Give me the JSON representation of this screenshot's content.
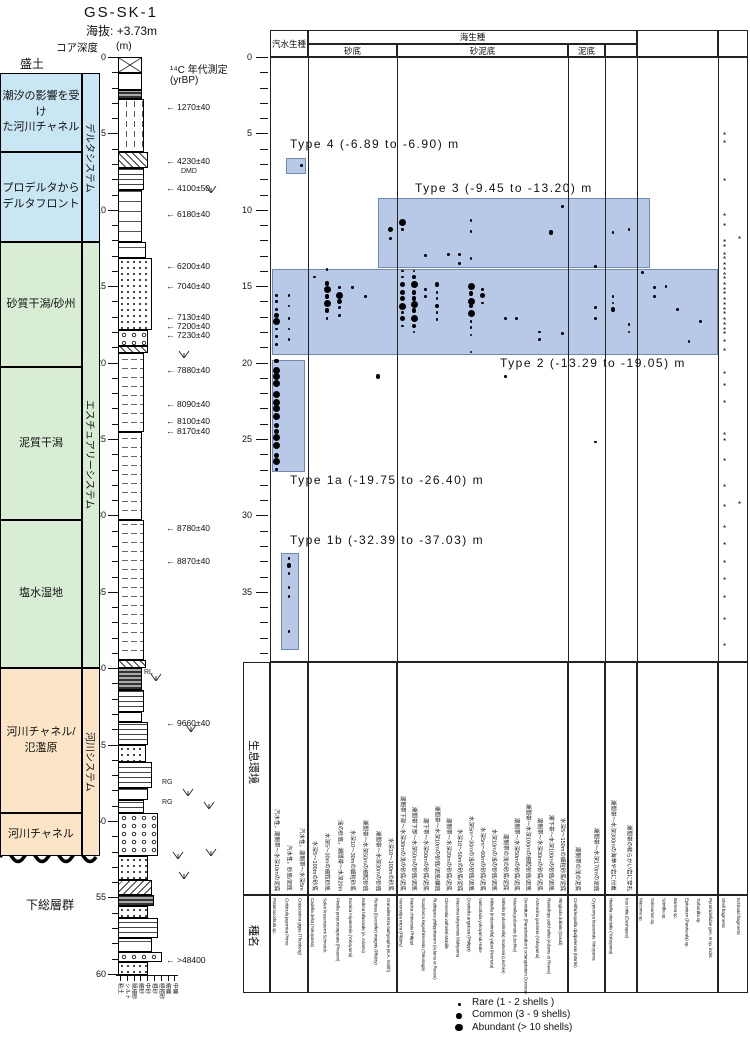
{
  "header": {
    "core_id": "GS-SK-1",
    "elevation_label": "海抜:",
    "elevation_value": "+3.73m",
    "core_depth_label": "コア深度",
    "depth_unit": "(m)",
    "c14_heading": "¹⁴C 年代測定",
    "c14_unit": "(yrBP)"
  },
  "left_panel": {
    "surface_label": "盛土",
    "basement_label": "下総層群",
    "environments": [
      {
        "label": "潮汐の影響を受け\nた河川チャネル",
        "color": "blue",
        "top_m": 1.05,
        "bottom_m": 6.22
      },
      {
        "label": "プロデルタから\nデルタフロント",
        "color": "blue",
        "top_m": 6.22,
        "bottom_m": 12.11
      },
      {
        "label": "砂質干潟/砂州",
        "color": "green",
        "top_m": 12.11,
        "bottom_m": 20.3
      },
      {
        "label": "泥質干潟",
        "color": "green",
        "top_m": 20.3,
        "bottom_m": 30.3
      },
      {
        "label": "塩水湿地",
        "color": "green",
        "top_m": 30.3,
        "bottom_m": 40.0
      },
      {
        "label": "河川チャネル/\n氾濫原",
        "color": "orange",
        "top_m": 40.0,
        "bottom_m": 49.5
      },
      {
        "label": "河川チャネル",
        "color": "orange",
        "top_m": 49.5,
        "bottom_m": 52.3
      }
    ],
    "systems": [
      {
        "label": "デルタシステム",
        "color": "blue",
        "top_m": 1.05,
        "bottom_m": 12.11
      },
      {
        "label": "エスチュアリーシステム",
        "color": "green",
        "top_m": 12.11,
        "bottom_m": 40.0
      },
      {
        "label": "河川システム",
        "color": "orange",
        "top_m": 40.0,
        "bottom_m": 52.3
      }
    ],
    "c14_dates": [
      {
        "label": "1270±40",
        "depth_m": 3.3
      },
      {
        "label": "4230±40",
        "depth_m": 6.8
      },
      {
        "label": "4100±50",
        "depth_m": 8.6
      },
      {
        "label": "6180±40",
        "depth_m": 10.3
      },
      {
        "label": "6200±40",
        "depth_m": 13.7
      },
      {
        "label": "7040±40",
        "depth_m": 15.0
      },
      {
        "label": "7130±40",
        "depth_m": 17.0
      },
      {
        "label": "7200±40",
        "depth_m": 17.6
      },
      {
        "label": "7230±40",
        "depth_m": 18.2
      },
      {
        "label": "7880±40",
        "depth_m": 20.5
      },
      {
        "label": "8090±40",
        "depth_m": 22.7
      },
      {
        "label": "8100±40",
        "depth_m": 23.8
      },
      {
        "label": "8170±40",
        "depth_m": 24.5
      },
      {
        "label": "8780±40",
        "depth_m": 30.8
      },
      {
        "label": "8870±40",
        "depth_m": 33.0
      },
      {
        "label": "9660±40",
        "depth_m": 43.6
      },
      {
        "label": ">48400",
        "depth_m": 59.1
      }
    ],
    "sed_marks": [
      {
        "label": "DMD",
        "depth_m": 7.5,
        "x": 181
      },
      {
        "label": "RL",
        "depth_m": 40.3,
        "x": 144
      },
      {
        "label": "RG",
        "depth_m": 47.5,
        "x": 162
      },
      {
        "label": "RG",
        "depth_m": 48.8,
        "x": 162
      }
    ],
    "grain_sizes": [
      "粘土",
      "シルト",
      "極細砂",
      "細砂",
      "中砂",
      "粗砂",
      "極粗砂",
      "細礫",
      "中礫"
    ]
  },
  "chart_data": {
    "type": "occurrence-matrix",
    "depth_axis": {
      "min": 0,
      "max": 39,
      "tick_step": 1,
      "label_step": 5,
      "unit": "m"
    },
    "marine_header": "海生種",
    "row_labels": {
      "habitat": "生息環境",
      "species": "種名"
    },
    "column_groups": [
      {
        "header": "汽水生種",
        "species": [
          {
            "name": "Potamocorbula sp.",
            "habitat": "汽水性，潮間帯～水深10mの泥底"
          },
          {
            "name": "Corbicula japonica Prime",
            "habitat": "汽水性，砂底/泥底"
          },
          {
            "name": "Crassostrea gigas (Thunberg)",
            "habitat": "汽水性，潮間帯～水深5m"
          }
        ]
      },
      {
        "header": "砂底",
        "species": [
          {
            "name": "Cadella delta (Yokoyama)",
            "habitat": "水深5～100mの砂底"
          },
          {
            "name": "Solen krusensterni Schrenck",
            "habitat": "水深5～30mの細粒砂底"
          },
          {
            "name": "Finella purpureoapicata (Preston)",
            "habitat": "浅の砂底，潮間帯～水深20m"
          },
          {
            "name": "Exotica miyatensis (Yokoyama)",
            "habitat": "水深10～30mの細粒砂底"
          },
          {
            "name": "Eulima bifascialis (A. Adams)",
            "habitat": "潮間帯～水深50mの細粒砂底"
          },
          {
            "name": "Retusa (Decorifer) insignis (Pilsbry)",
            "habitat": "潮間帯～水深30mの砂底"
          },
          {
            "name": "Granuliterebra bathyraphe (E.A. Smith)",
            "habitat": "水深10～100mの砂底"
          }
        ]
      },
      {
        "header": "砂泥底",
        "species": [
          {
            "name": "Veremolpa micra (Pilsbry)",
            "habitat": "潮間帯下部～水深30mの浅の砂底/泥底"
          },
          {
            "name": "Mactra chinensis Philippi",
            "habitat": "潮間帯下部～水深50mの砂底/泥底"
          },
          {
            "name": "Scapharca kagoshimensis (Tokunaga)",
            "habitat": "潮下帯～水深50mの砂底/泥底"
          },
          {
            "name": "Ruditapes philippinarum (Adams et Reeve)",
            "habitat": "潮間帯～水深10mの砂底/泥底/礫底"
          },
          {
            "name": "Clementia vatheleti Mabille",
            "habitat": "潮間帯～水深20mの砂底/泥底"
          },
          {
            "name": "Macoma tokyoensis Makiyama",
            "habitat": "水深10～50mの砂底/泥底"
          },
          {
            "name": "Dosinella angulosa (Philippi)",
            "habitat": "水深5m～30mの浅の砂底/泥底"
          },
          {
            "name": "Varicorbula yokoyamai Habe",
            "habitat": "水深5m～60mの砂底/泥底"
          },
          {
            "name": "Mitrella (Indomitrella) yabei (Nomura)",
            "habitat": "水深10mの浅の砂底/泥底"
          },
          {
            "name": "Mitrella (Indomitrella) martensi (Lischke)",
            "habitat": "潮間帯の浅の砂底/泥底"
          },
          {
            "name": "Moerella jedoensis (Lischke)",
            "habitat": "潮間帯～水深50mの砂底/泥底"
          },
          {
            "name": "Dentalium (Paradentalium) octangulatum Donovan",
            "habitat": "潮間帯～水深100mの細粒砂底/泥底"
          },
          {
            "name": "Acteocina gordonis (Yokoyama)",
            "habitat": "潮間帯～水深30mの砂底/泥底"
          },
          {
            "name": "Raetellops pulchellus (Adams et Reeve)",
            "habitat": "潮下帯～水深100mの砂底/泥底"
          },
          {
            "name": "Ringicula doliaris (Gould)",
            "habitat": "水深5～150mの細粒砂底/泥底"
          }
        ]
      },
      {
        "header": "泥底",
        "species": [
          {
            "name": "Cerithideopsilla djadjariensis (Martin)",
            "habitat": "潮間帯の浅の泥底"
          },
          {
            "name": "Cryptomya busoensis Yokoyama",
            "habitat": "潮間帯～水深170mの泥底"
          }
        ]
      },
      {
        "header": "",
        "species": [
          {
            "name": "Hiatella orientalis (Yokoyama)",
            "habitat": "潮間帯～水深300mの海草や岩に付着"
          },
          {
            "name": "Irus mitis (Deshayes)",
            "habitat": "潮間帯の軟らかい岩に穿孔"
          }
        ]
      },
      {
        "header": "",
        "species": [
          {
            "name": "Macoma sp.",
            "habitat": ""
          },
          {
            "name": "Solecurtus sp.",
            "habitat": ""
          },
          {
            "name": "Scintilla sp.",
            "habitat": ""
          },
          {
            "name": "Barnea sp.",
            "habitat": ""
          },
          {
            "name": "Epitonium (Parviscala) sp.",
            "habitat": ""
          },
          {
            "name": "Turbonilla sp.",
            "habitat": ""
          },
          {
            "name": "Pyramidellidae gen. et sp. indet.",
            "habitat": ""
          }
        ]
      },
      {
        "header": "",
        "species": [
          {
            "name": "Shell fragments",
            "habitat": ""
          },
          {
            "name": "Echinoid fragments",
            "habitat": ""
          }
        ]
      }
    ],
    "shell_types": [
      {
        "label": "Type 4 (-6.89 to -6.90) m"
      },
      {
        "label": "Type 3 (-9.45 to -13.20) m"
      },
      {
        "label": "Type 2 (-13.29 to -19.05) m"
      },
      {
        "label": "Type 1a (-19.75 to -26.40) m"
      },
      {
        "label": "Type 1b (-32.39 to -37.03) m"
      }
    ],
    "size_classes": {
      "0": "fragment mark",
      "1": "Rare (1-2 shells)",
      "2": "Common (3-9 shells)",
      "3": "Abundant (>10 shells)"
    },
    "occurrences": [
      [
        0,
        15.6,
        1
      ],
      [
        0,
        16.0,
        1
      ],
      [
        0,
        16.5,
        1
      ],
      [
        0,
        16.9,
        2
      ],
      [
        0,
        17.3,
        3
      ],
      [
        0,
        17.8,
        1
      ],
      [
        0,
        18.3,
        1
      ],
      [
        0,
        18.8,
        1
      ],
      [
        0,
        19.9,
        2
      ],
      [
        0,
        20.5,
        3
      ],
      [
        0,
        20.9,
        3
      ],
      [
        0,
        21.4,
        3
      ],
      [
        0,
        22.1,
        3
      ],
      [
        0,
        22.6,
        3
      ],
      [
        0,
        23.0,
        3
      ],
      [
        0,
        23.5,
        3
      ],
      [
        0,
        24.1,
        2
      ],
      [
        0,
        24.5,
        2
      ],
      [
        0,
        24.9,
        3
      ],
      [
        0,
        25.4,
        3
      ],
      [
        0,
        26.1,
        2
      ],
      [
        0,
        26.5,
        3
      ],
      [
        0,
        27.0,
        1
      ],
      [
        1,
        15.6,
        1
      ],
      [
        1,
        16.3,
        1
      ],
      [
        1,
        17.1,
        1
      ],
      [
        1,
        17.8,
        1
      ],
      [
        1,
        18.5,
        1
      ],
      [
        1,
        32.8,
        1
      ],
      [
        1,
        33.3,
        2
      ],
      [
        1,
        33.8,
        1
      ],
      [
        1,
        34.7,
        1
      ],
      [
        1,
        35.3,
        1
      ],
      [
        1,
        37.6,
        1
      ],
      [
        2,
        7.1,
        1
      ],
      [
        3,
        14.4,
        1
      ],
      [
        4,
        13.9,
        1
      ],
      [
        4,
        14.8,
        2
      ],
      [
        4,
        15.2,
        3
      ],
      [
        4,
        15.7,
        2
      ],
      [
        4,
        16.1,
        3
      ],
      [
        4,
        16.6,
        2
      ],
      [
        4,
        17.1,
        1
      ],
      [
        5,
        15.1,
        1
      ],
      [
        5,
        15.6,
        3
      ],
      [
        5,
        16.0,
        2
      ],
      [
        5,
        16.4,
        1
      ],
      [
        5,
        16.9,
        1
      ],
      [
        6,
        15.1,
        1
      ],
      [
        7,
        15.7,
        1
      ],
      [
        8,
        20.9,
        2
      ],
      [
        9,
        11.3,
        2
      ],
      [
        9,
        11.9,
        1
      ],
      [
        10,
        10.8,
        3
      ],
      [
        10,
        11.3,
        1
      ],
      [
        10,
        14.0,
        1
      ],
      [
        10,
        14.4,
        1
      ],
      [
        10,
        14.9,
        2
      ],
      [
        10,
        15.4,
        2
      ],
      [
        10,
        15.8,
        2
      ],
      [
        10,
        16.3,
        3
      ],
      [
        10,
        16.7,
        1
      ],
      [
        10,
        17.1,
        2
      ],
      [
        10,
        17.6,
        1
      ],
      [
        11,
        14.0,
        1
      ],
      [
        11,
        14.4,
        2
      ],
      [
        11,
        14.9,
        3
      ],
      [
        11,
        15.4,
        2
      ],
      [
        11,
        15.8,
        2
      ],
      [
        11,
        16.2,
        3
      ],
      [
        11,
        16.6,
        2
      ],
      [
        11,
        17.1,
        3
      ],
      [
        11,
        17.6,
        2
      ],
      [
        11,
        18.0,
        1
      ],
      [
        12,
        13.0,
        1
      ],
      [
        12,
        15.2,
        1
      ],
      [
        12,
        15.7,
        1
      ],
      [
        13,
        14.9,
        2
      ],
      [
        13,
        15.4,
        1
      ],
      [
        13,
        15.8,
        1
      ],
      [
        13,
        16.3,
        2
      ],
      [
        13,
        16.7,
        1
      ],
      [
        13,
        17.2,
        1
      ],
      [
        14,
        12.9,
        1
      ],
      [
        15,
        12.9,
        1
      ],
      [
        15,
        13.5,
        1
      ],
      [
        16,
        10.7,
        1
      ],
      [
        16,
        11.4,
        1
      ],
      [
        16,
        13.2,
        1
      ],
      [
        16,
        15.0,
        3
      ],
      [
        16,
        15.5,
        2
      ],
      [
        16,
        16.0,
        3
      ],
      [
        16,
        16.3,
        2
      ],
      [
        16,
        16.8,
        3
      ],
      [
        16,
        17.3,
        1
      ],
      [
        16,
        17.7,
        1
      ],
      [
        16,
        18.2,
        1
      ],
      [
        16,
        19.3,
        1
      ],
      [
        17,
        15.2,
        1
      ],
      [
        17,
        15.6,
        2
      ],
      [
        17,
        16.1,
        1
      ],
      [
        19,
        17.1,
        1
      ],
      [
        19,
        20.9,
        1
      ],
      [
        20,
        17.1,
        1
      ],
      [
        22,
        18.0,
        1
      ],
      [
        22,
        18.5,
        1
      ],
      [
        23,
        11.5,
        2
      ],
      [
        24,
        9.8,
        1
      ],
      [
        24,
        18.1,
        1
      ],
      [
        26,
        13.7,
        1
      ],
      [
        26,
        16.4,
        1
      ],
      [
        26,
        17.1,
        1
      ],
      [
        26,
        25.2,
        1
      ],
      [
        27,
        11.5,
        1
      ],
      [
        27,
        15.7,
        1
      ],
      [
        27,
        16.1,
        1
      ],
      [
        27,
        16.5,
        2
      ],
      [
        28,
        11.3,
        1
      ],
      [
        28,
        17.5,
        1
      ],
      [
        28,
        18.0,
        1
      ],
      [
        29,
        14.1,
        1
      ],
      [
        30,
        15.1,
        1
      ],
      [
        30,
        15.7,
        1
      ],
      [
        31,
        15.0,
        1
      ],
      [
        32,
        16.5,
        1
      ],
      [
        33,
        18.6,
        1
      ],
      [
        34,
        17.3,
        1
      ],
      [
        36,
        5.2,
        0
      ],
      [
        36,
        5.7,
        0
      ],
      [
        36,
        8.2,
        0
      ],
      [
        36,
        10.5,
        0
      ],
      [
        36,
        11.1,
        0
      ],
      [
        36,
        12.2,
        0
      ],
      [
        36,
        12.5,
        0
      ],
      [
        36,
        13.0,
        0
      ],
      [
        36,
        13.3,
        0
      ],
      [
        36,
        13.7,
        0
      ],
      [
        36,
        14.0,
        0
      ],
      [
        36,
        14.3,
        0
      ],
      [
        36,
        14.6,
        0
      ],
      [
        36,
        15.0,
        0
      ],
      [
        36,
        15.3,
        0
      ],
      [
        36,
        15.6,
        0
      ],
      [
        36,
        16.0,
        0
      ],
      [
        36,
        16.3,
        0
      ],
      [
        36,
        16.6,
        0
      ],
      [
        36,
        16.9,
        0
      ],
      [
        36,
        17.3,
        0
      ],
      [
        36,
        17.6,
        0
      ],
      [
        36,
        17.9,
        0
      ],
      [
        36,
        18.2,
        0
      ],
      [
        36,
        18.7,
        0
      ],
      [
        36,
        19.3,
        0
      ],
      [
        36,
        20.8,
        0
      ],
      [
        36,
        21.6,
        0
      ],
      [
        36,
        22.7,
        0
      ],
      [
        36,
        24.8,
        0
      ],
      [
        36,
        25.2,
        0
      ],
      [
        36,
        26.5,
        0
      ],
      [
        36,
        28.2,
        0
      ],
      [
        36,
        29.5,
        0
      ],
      [
        36,
        30.9,
        0
      ],
      [
        36,
        32.0,
        0
      ],
      [
        36,
        33.2,
        0
      ],
      [
        36,
        34.3,
        0
      ],
      [
        36,
        35.5,
        0
      ],
      [
        36,
        36.9,
        0
      ],
      [
        36,
        38.6,
        0
      ],
      [
        37,
        12.0,
        0
      ],
      [
        37,
        29.3,
        0
      ]
    ]
  },
  "legend": {
    "items": [
      {
        "size": 1,
        "label": "Rare (1 - 2 shells )"
      },
      {
        "size": 2,
        "label": "Common (3 - 9 shells)"
      },
      {
        "size": 3,
        "label": "Abundant (> 10 shells)"
      }
    ]
  }
}
